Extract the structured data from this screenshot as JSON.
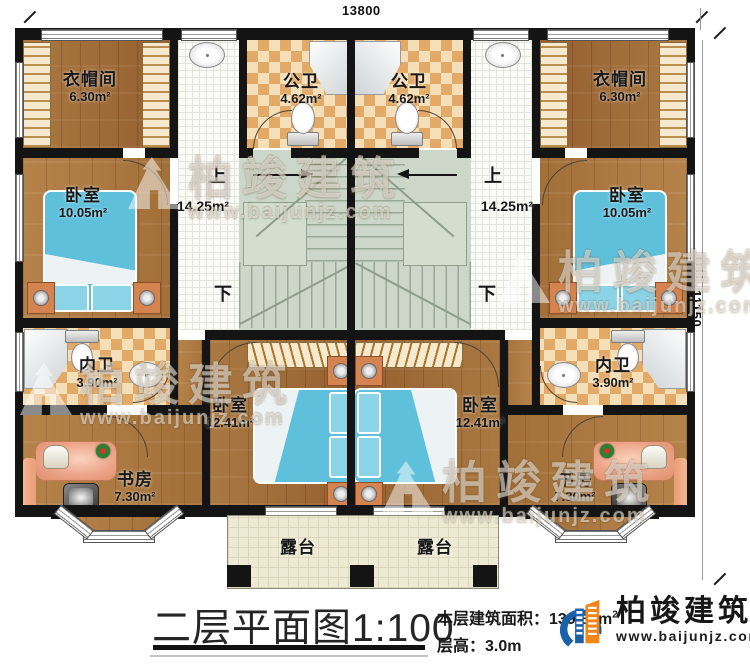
{
  "dimensions": {
    "top": "13800",
    "right": "11150"
  },
  "rooms": {
    "cloakroom": {
      "label": "衣帽间",
      "area": "6.30m²"
    },
    "public_bath": {
      "label": "公卫",
      "area": "4.62m²"
    },
    "bedroom_small": {
      "label": "卧室",
      "area": "10.05m²"
    },
    "ensuite_bath": {
      "label": "内卫",
      "area": "3.90m²"
    },
    "bedroom_large": {
      "label": "卧室",
      "area": "12.41m²"
    },
    "study": {
      "label": "书房",
      "area": "7.30m²"
    },
    "terrace": {
      "label": "露台"
    }
  },
  "stairs": {
    "up": "上",
    "down": "下",
    "area": "14.25m²"
  },
  "footer": {
    "title": "二层平面图",
    "scale": "1:100",
    "area_label": "本层建筑面积：",
    "area_value": "139.84m",
    "area_sup": "2",
    "floor_height_label": "层高：",
    "floor_height_value": "3.0m"
  },
  "brand": {
    "name": "柏竣建筑",
    "site": "www.baijunjz.com"
  },
  "watermark": {
    "name": "柏竣建筑",
    "site": "www.baijunjz.com"
  },
  "colors": {
    "wall": "#141414",
    "logo_blue": "#1961a8",
    "logo_orange": "#f08519",
    "bed": "#5fc0db",
    "tile_accent": "#e3a966",
    "stairs": "#ccd7ca"
  }
}
